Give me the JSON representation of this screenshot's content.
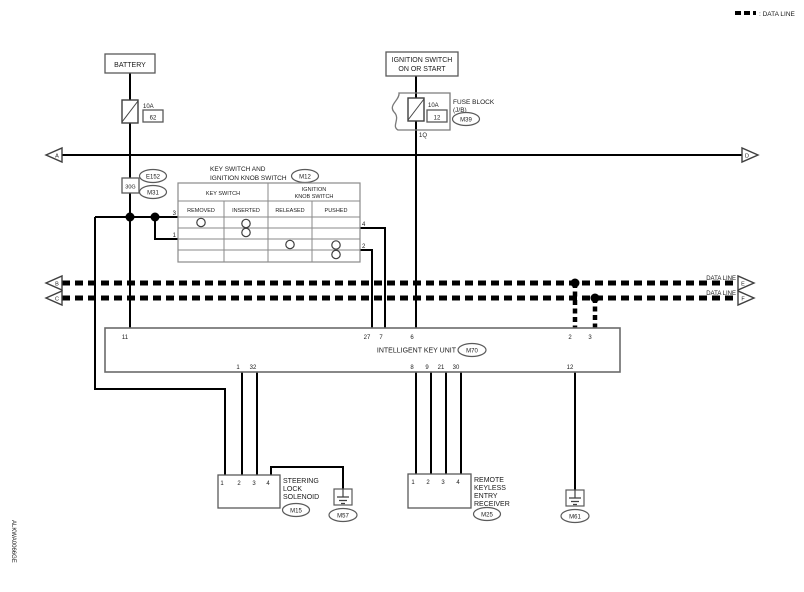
{
  "legend": {
    "data_line": ": DATA LINE"
  },
  "page_refs": {
    "left_power": "A",
    "right_power": "D",
    "left_data_top": "B",
    "left_data_bottom": "C",
    "right_data_top": "E",
    "right_data_bottom": "F"
  },
  "data_line_label_top": "DATA LINE",
  "data_line_label_bottom": "DATA LINE",
  "battery": {
    "label": "BATTERY",
    "fuse_rating": "10A",
    "fuse_number": "62"
  },
  "ignition": {
    "label_line1": "IGNITION SWITCH",
    "label_line2": "ON OR START",
    "fuse_rating": "10A",
    "fuse_number": "12",
    "fuse_block_line1": "FUSE BLOCK",
    "fuse_block_line2": "(J/B)",
    "connector": "M39",
    "pin": "1Q"
  },
  "junctions": {
    "connector_top": "E152",
    "pin": "30G",
    "connector_bottom": "M31"
  },
  "key_switch": {
    "title_line1": "KEY SWITCH AND",
    "title_line2": "IGNITION KNOB SWITCH",
    "connector": "M12",
    "group_key": "KEY SWITCH",
    "group_knob_line1": "IGNITION",
    "group_knob_line2": "KNOB SWITCH",
    "col_removed": "REMOVED",
    "col_inserted": "INSERTED",
    "col_released": "RELEASED",
    "col_pushed": "PUSHED",
    "pin_3": "3",
    "pin_1": "1",
    "pin_4": "4",
    "pin_2": "2"
  },
  "key_unit": {
    "title": "INTELLIGENT KEY UNIT",
    "connector": "M70",
    "pins_top": [
      "11",
      "27",
      "7",
      "6",
      "2",
      "3"
    ],
    "pins_bottom": [
      "1",
      "32",
      "8",
      "9",
      "21",
      "30",
      "12"
    ]
  },
  "solenoid": {
    "label_lines": [
      "STEERING",
      "LOCK",
      "SOLENOID"
    ],
    "connector": "M15",
    "pins": [
      "1",
      "2",
      "3",
      "4"
    ]
  },
  "receiver": {
    "label_lines": [
      "REMOTE",
      "KEYLESS",
      "ENTRY",
      "RECEIVER"
    ],
    "connector": "M25",
    "pins": [
      "1",
      "2",
      "3",
      "4"
    ]
  },
  "grounds": {
    "left": "M57",
    "right": "M61"
  },
  "footer_code": "ALKWA0066GE"
}
